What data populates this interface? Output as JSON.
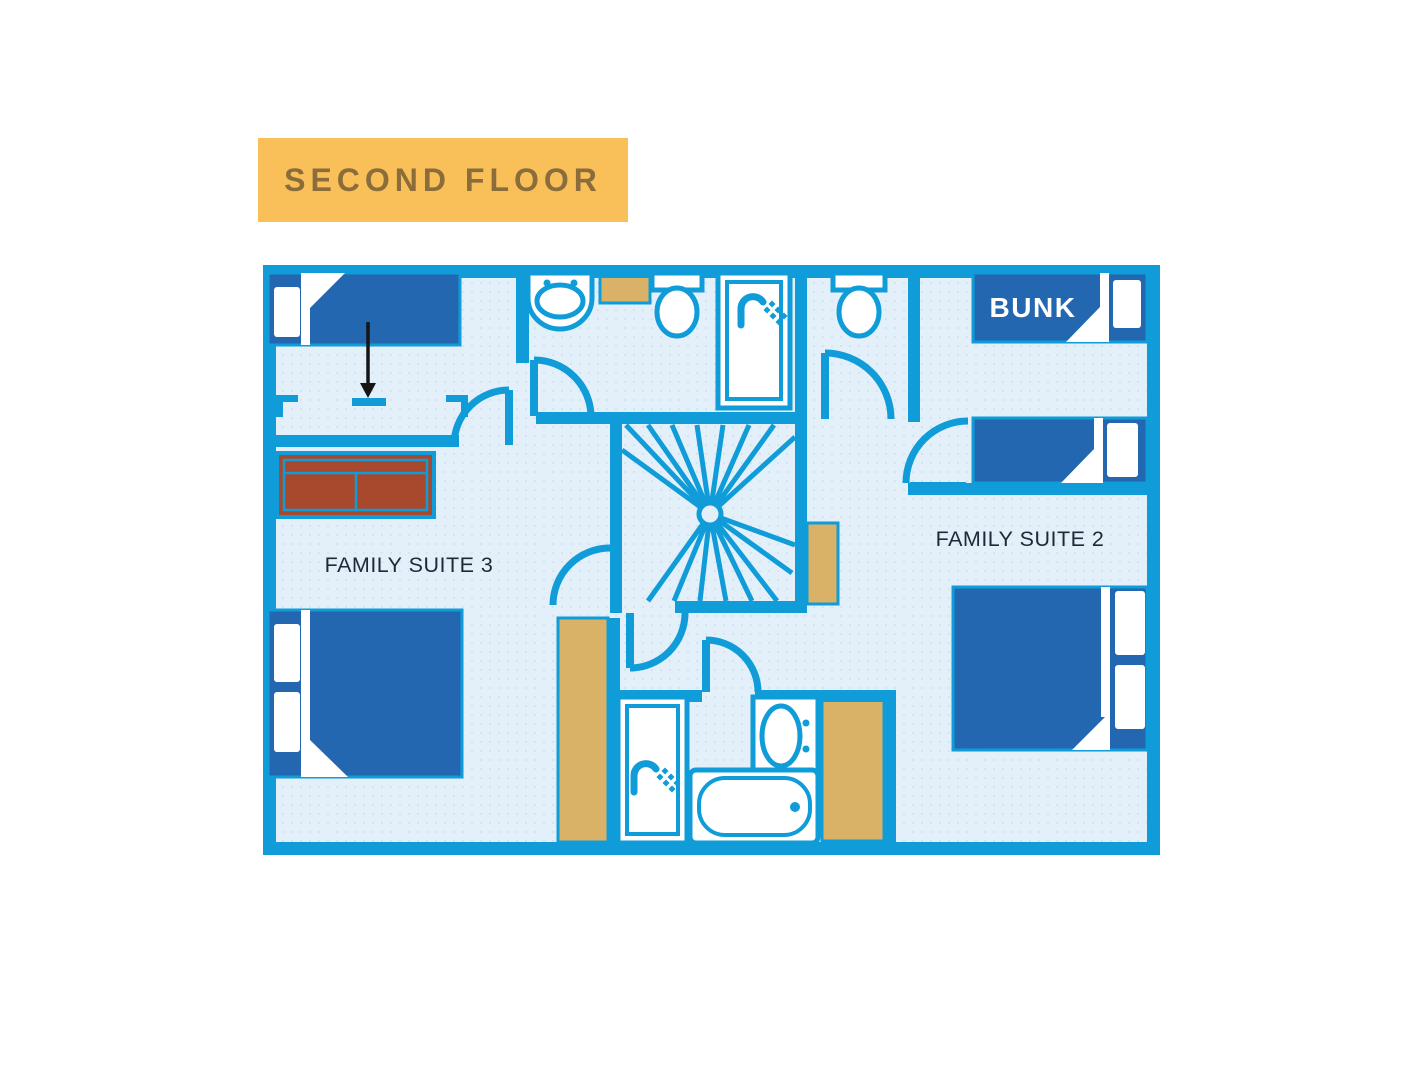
{
  "header": {
    "label": "SECOND FLOOR"
  },
  "floorplan": {
    "labels": {
      "suite3": "FAMILY SUITE 3",
      "suite2": "FAMILY SUITE 2",
      "bunk": "BUNK"
    },
    "colors": {
      "wall": "#0F9CD9",
      "floor": "#E3F0F9",
      "floor_dot": "#CCE2F1",
      "bed": "#2267AF",
      "pillow": "#FFFFFF",
      "tan": "#D9B267",
      "sofa": "#A8492E",
      "arrow": "#151515",
      "label_text": "#1E2936",
      "bunk_text": "#FFFFFF",
      "header_bg": "#F9C05A",
      "header_text": "#8A6D3A"
    }
  }
}
